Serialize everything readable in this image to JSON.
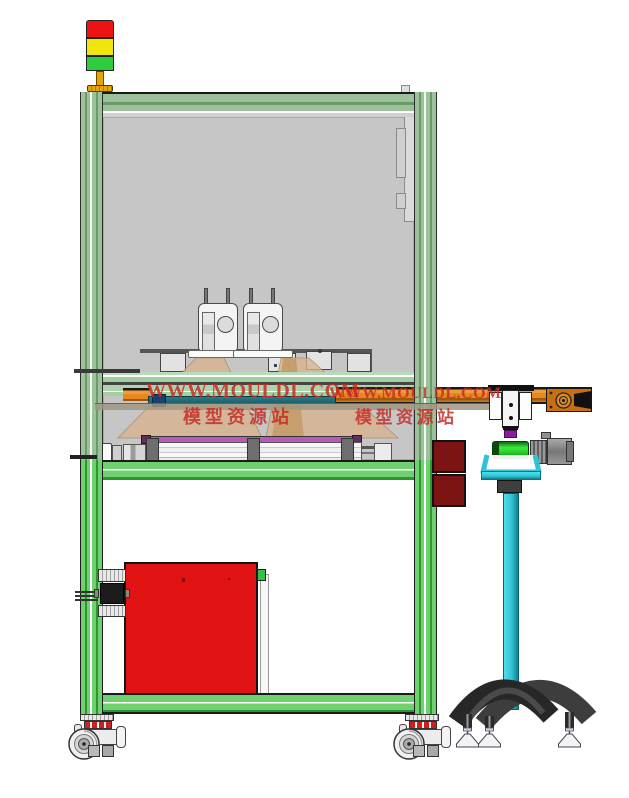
{
  "watermark": {
    "site": "WWW.MOULDL.COM",
    "site_cn": "模型资源站"
  },
  "colors": {
    "frame_green": "#6fd06f",
    "frame_green_dark": "#2e962e",
    "frame_green_muted": "#9cc29c",
    "frame_green_muted_dark": "#6a9a6a",
    "panel_gray": "#c6c6c6",
    "conveyor_orange": "#e8871e",
    "conveyor_orange_dark": "#a05810",
    "cabinet_red": "#e01212",
    "box_maroon": "#7c1414",
    "watermark_red": "#c62d26",
    "pole_cyan": "#2fc3d6",
    "pole_cyan_dark": "#0f7e8d",
    "roller_green": "#2ad42a",
    "light_red": "#ee1313",
    "light_yellow": "#f2e40e",
    "light_green": "#2fcc3f",
    "tower_amber": "#e8a400",
    "fan_tan": "#d9b48f",
    "rail_purple": "#b85ab8",
    "guide_teal": "#1d5f6b",
    "gripper_purple": "#8b1a9e",
    "base_dark": "#2d2d2d"
  }
}
